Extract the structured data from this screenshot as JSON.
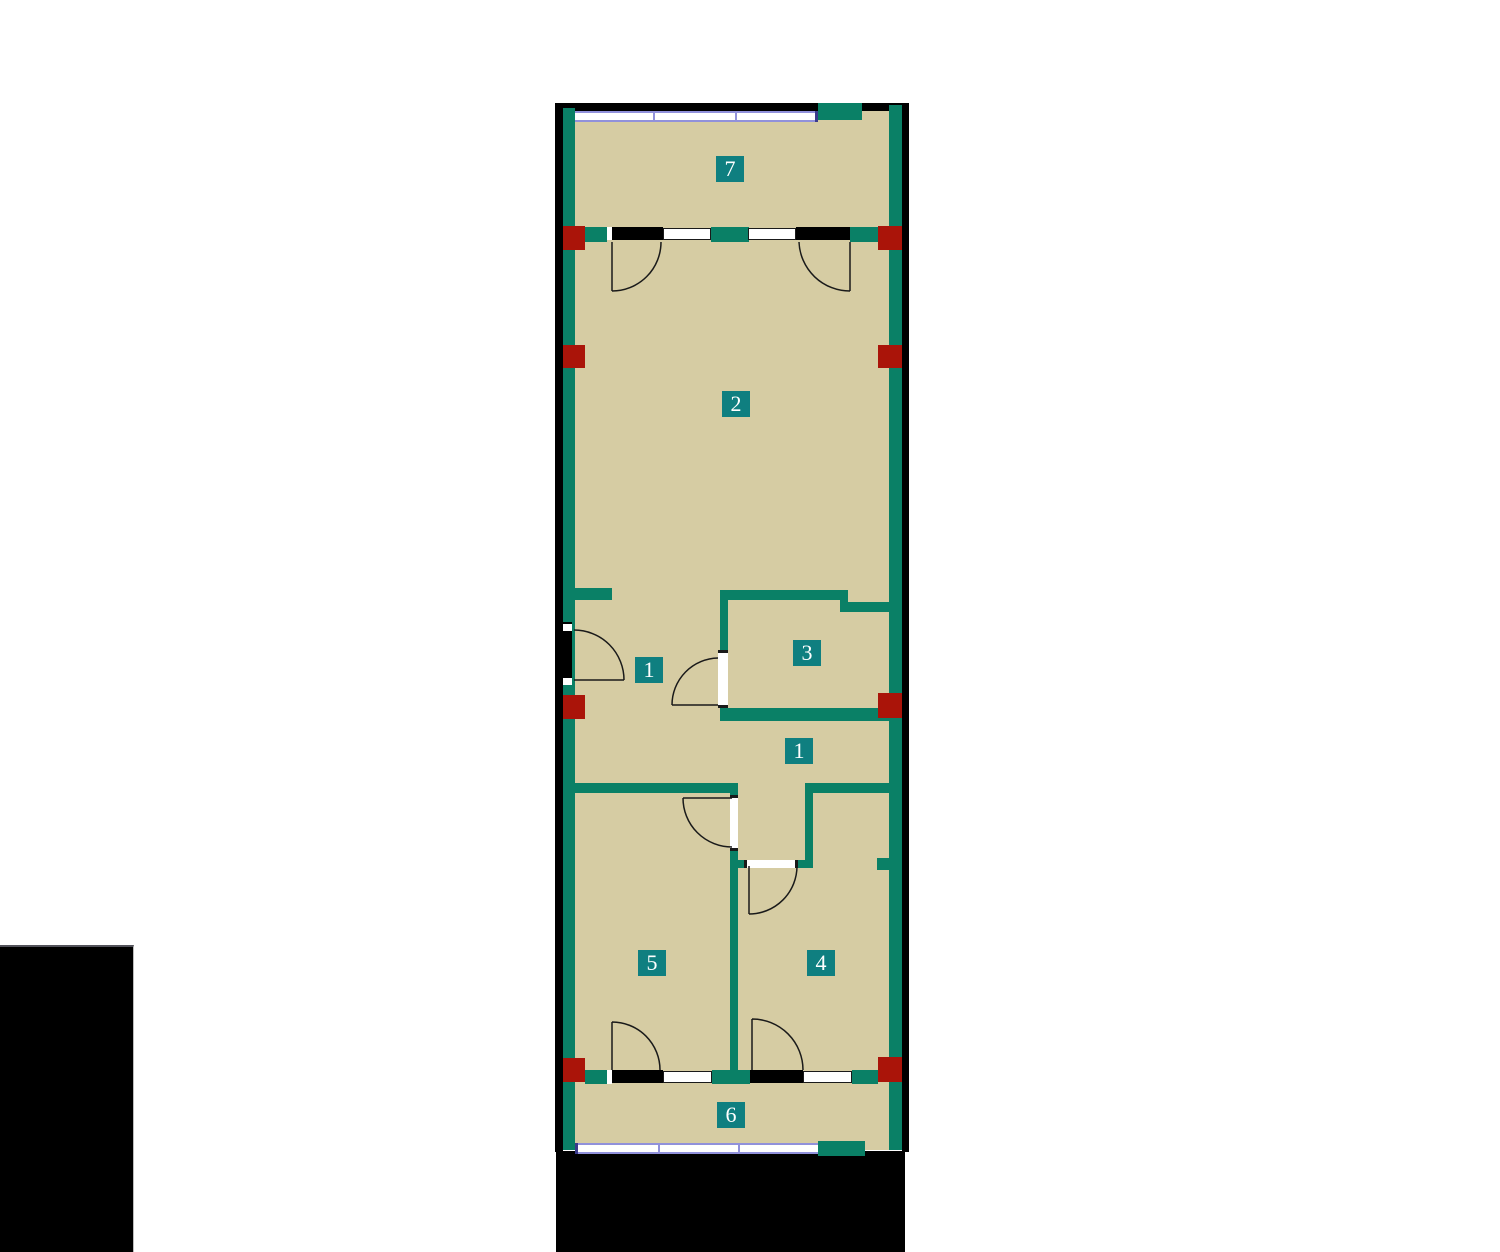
{
  "plan": {
    "rooms": [
      {
        "id": "room-7",
        "label": "7"
      },
      {
        "id": "room-2",
        "label": "2"
      },
      {
        "id": "hall-1-upper",
        "label": "1"
      },
      {
        "id": "room-3",
        "label": "3"
      },
      {
        "id": "hall-1-lower",
        "label": "1"
      },
      {
        "id": "room-5",
        "label": "5"
      },
      {
        "id": "room-4",
        "label": "4"
      },
      {
        "id": "room-6",
        "label": "6"
      }
    ],
    "colors": {
      "floor": "#D6CCA3",
      "wall": "#0A8066",
      "label": "#0F7F80",
      "column": "#AA1409",
      "window": "#9191DB",
      "window_dark": "#3B3B8C",
      "line": "#1A1A1A",
      "black": "#000000",
      "background": "#FFFFFF"
    }
  }
}
